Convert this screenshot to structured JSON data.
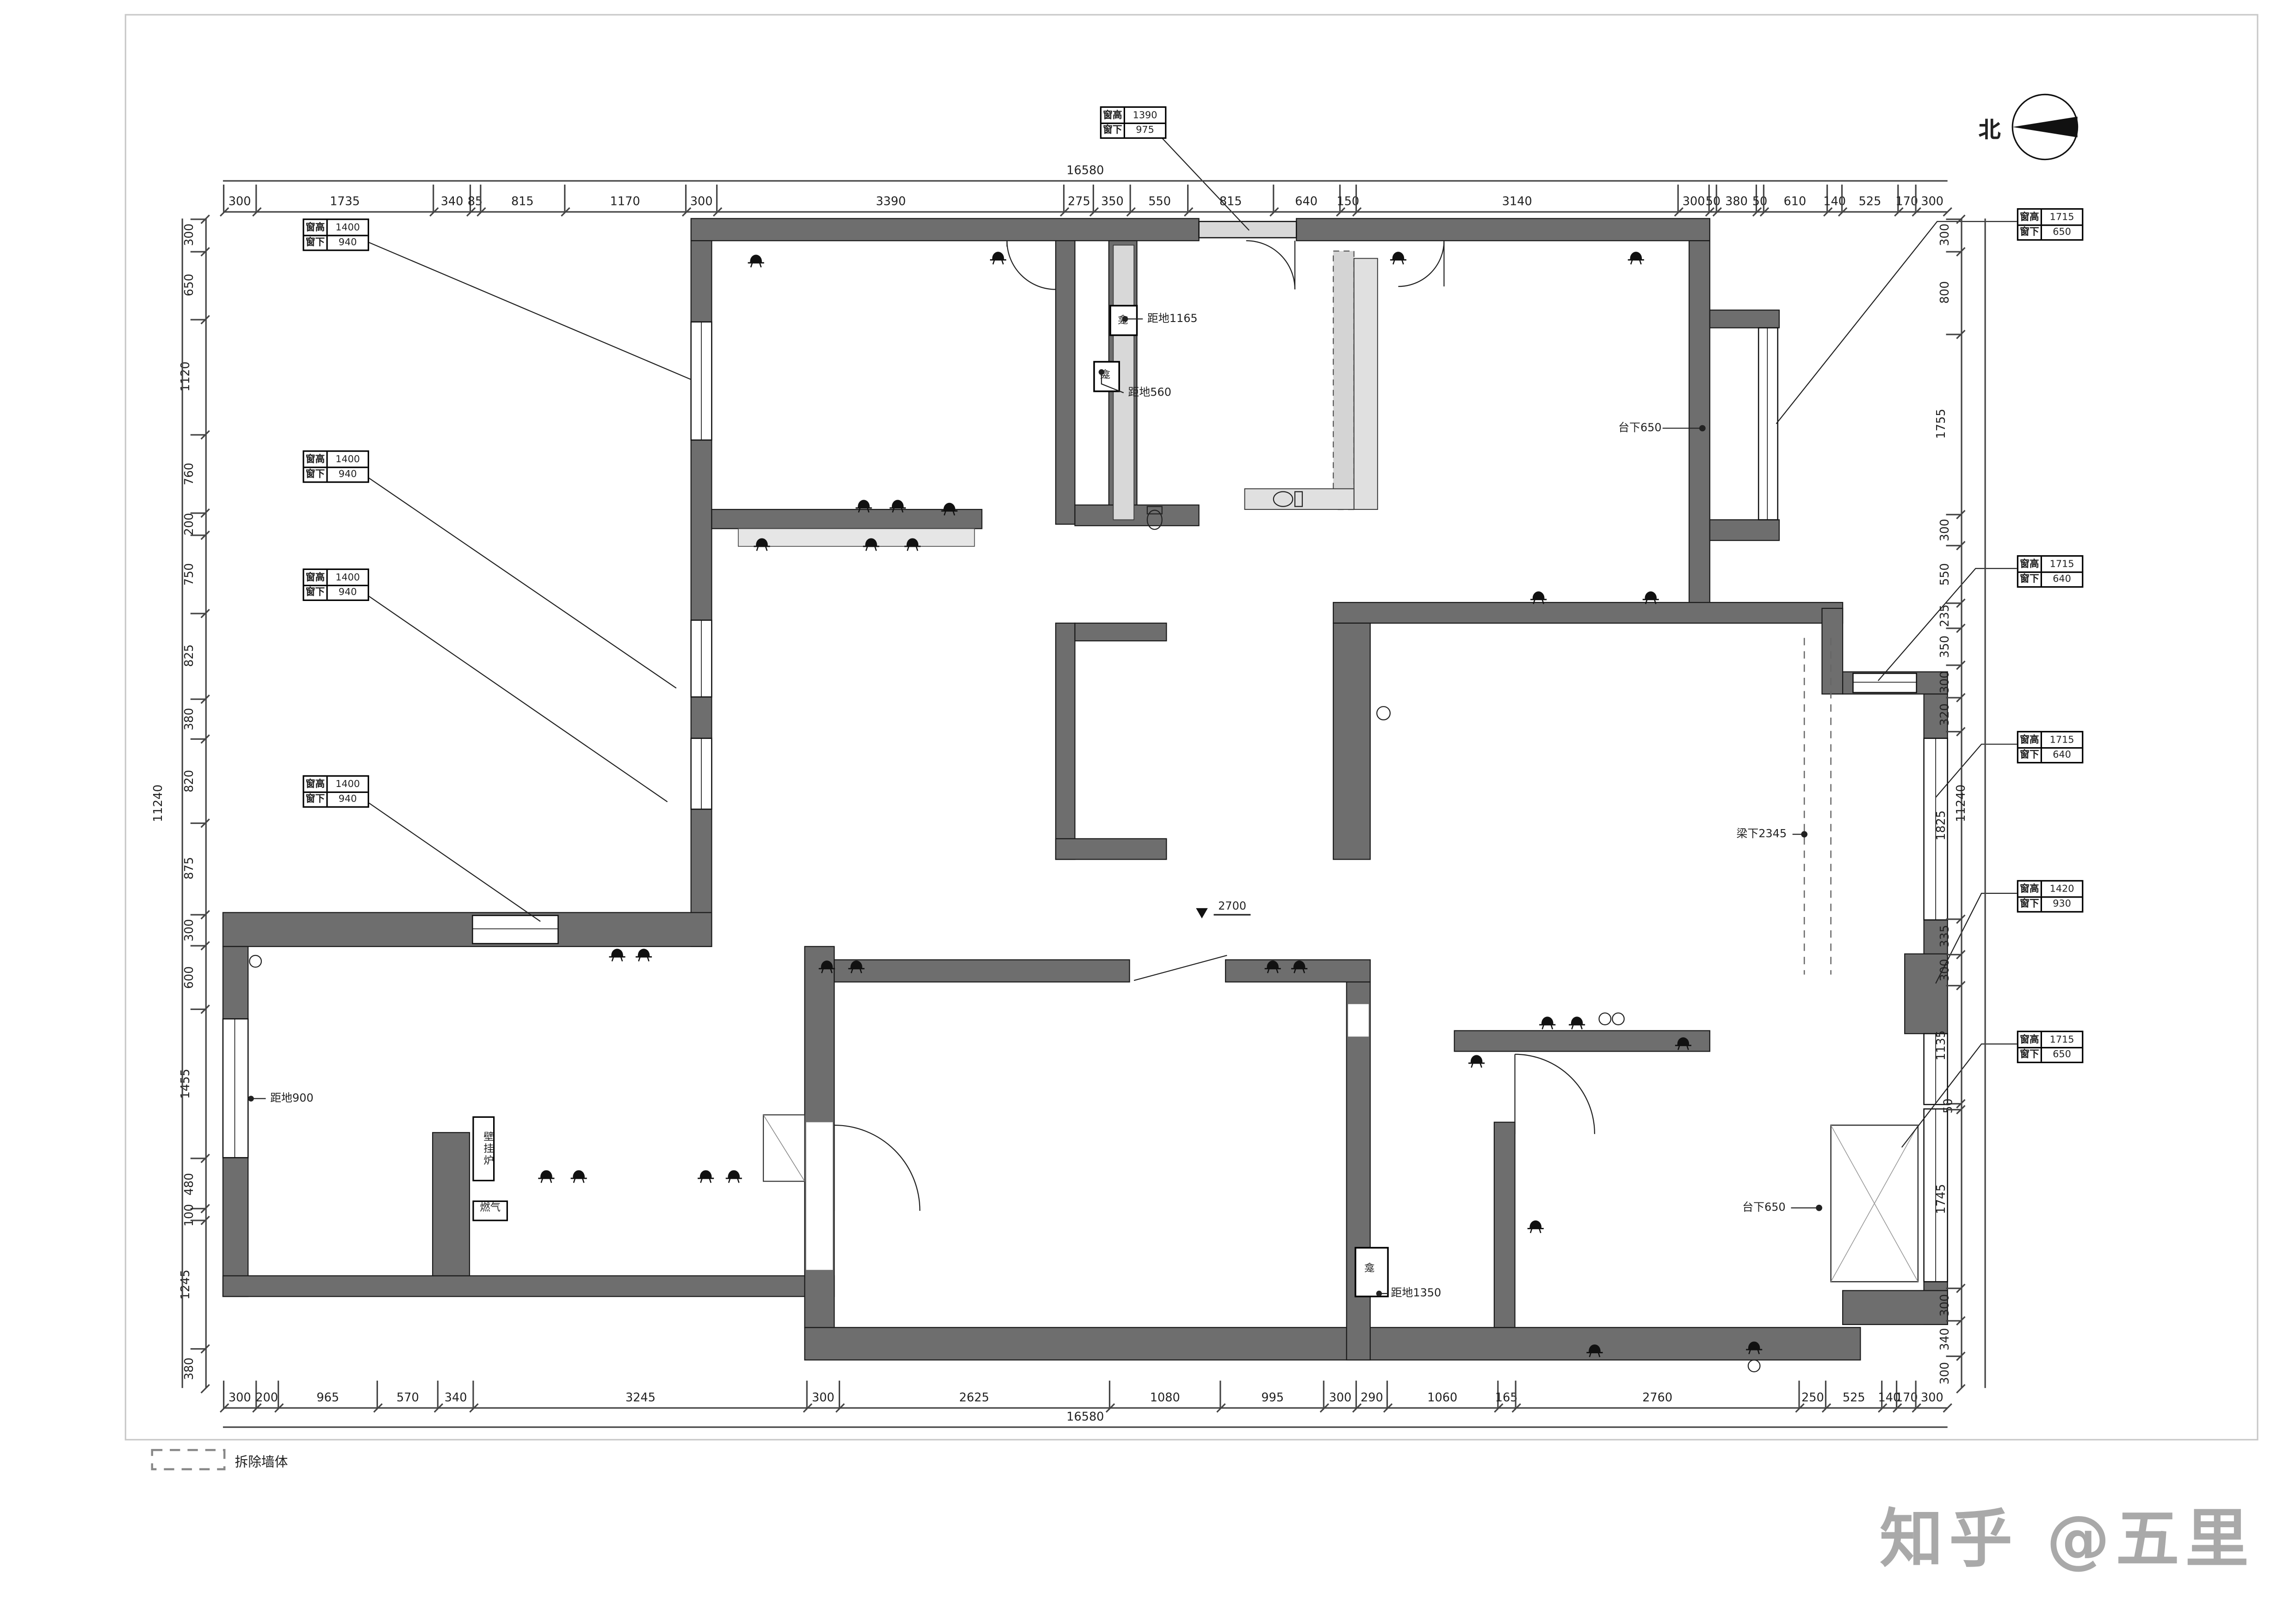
{
  "watermark": "知乎 @五里",
  "north": {
    "label": "北"
  },
  "legend": {
    "label": "拆除墙体"
  },
  "dims": {
    "top": {
      "total": "16580",
      "segments": [
        "300",
        "1735",
        "340",
        "85",
        "815",
        "1170",
        "300",
        "3390",
        "275",
        "350",
        "550",
        "815",
        "640",
        "150",
        "3140",
        "300",
        "50",
        "380",
        "50",
        "610",
        "140",
        "525",
        "170",
        "300"
      ]
    },
    "bottom": {
      "total": "16580",
      "segments": [
        "300",
        "200",
        "965",
        "570",
        "340",
        "3245",
        "300",
        "2625",
        "1080",
        "995",
        "300",
        "290",
        "1060",
        "165",
        "2760",
        "250",
        "525",
        "140",
        "170",
        "300"
      ]
    },
    "left": {
      "total": "11240",
      "segments": [
        "300",
        "650",
        "1120",
        "760",
        "200",
        "750",
        "825",
        "380",
        "820",
        "875",
        "300",
        "600",
        "1455",
        "480",
        "100",
        "1245",
        "380"
      ]
    },
    "right": {
      "total": "11240",
      "segments": [
        "300",
        "800",
        "1755",
        "300",
        "550",
        "235",
        "350",
        "300",
        "320",
        "1825",
        "335",
        "300",
        "1135",
        "50",
        "1745",
        "300",
        "340",
        "300"
      ]
    }
  },
  "window_tags": [
    {
      "k1": "窗高",
      "v1": "1390",
      "k2": "窗下",
      "v2": "975"
    },
    {
      "k1": "窗高",
      "v1": "1400",
      "k2": "窗下",
      "v2": "940"
    },
    {
      "k1": "窗高",
      "v1": "1400",
      "k2": "窗下",
      "v2": "940"
    },
    {
      "k1": "窗高",
      "v1": "1400",
      "k2": "窗下",
      "v2": "940"
    },
    {
      "k1": "窗高",
      "v1": "1400",
      "k2": "窗下",
      "v2": "940"
    },
    {
      "k1": "窗高",
      "v1": "1715",
      "k2": "窗下",
      "v2": "650"
    },
    {
      "k1": "窗高",
      "v1": "1715",
      "k2": "窗下",
      "v2": "640"
    },
    {
      "k1": "窗高",
      "v1": "1715",
      "k2": "窗下",
      "v2": "640"
    },
    {
      "k1": "窗高",
      "v1": "1420",
      "k2": "窗下",
      "v2": "930"
    },
    {
      "k1": "窗高",
      "v1": "1715",
      "k2": "窗下",
      "v2": "650"
    }
  ],
  "annotations": {
    "dd1165": "距地1165",
    "dd560": "距地560",
    "tx650_top": "台下650",
    "lx2345": "梁下2345",
    "dd900": "距地900",
    "boiler": "壁挂炉",
    "gas": "燃气",
    "dd1350": "距地1350",
    "tx650_btm": "台下650",
    "level": "2700",
    "niche": "龛"
  }
}
